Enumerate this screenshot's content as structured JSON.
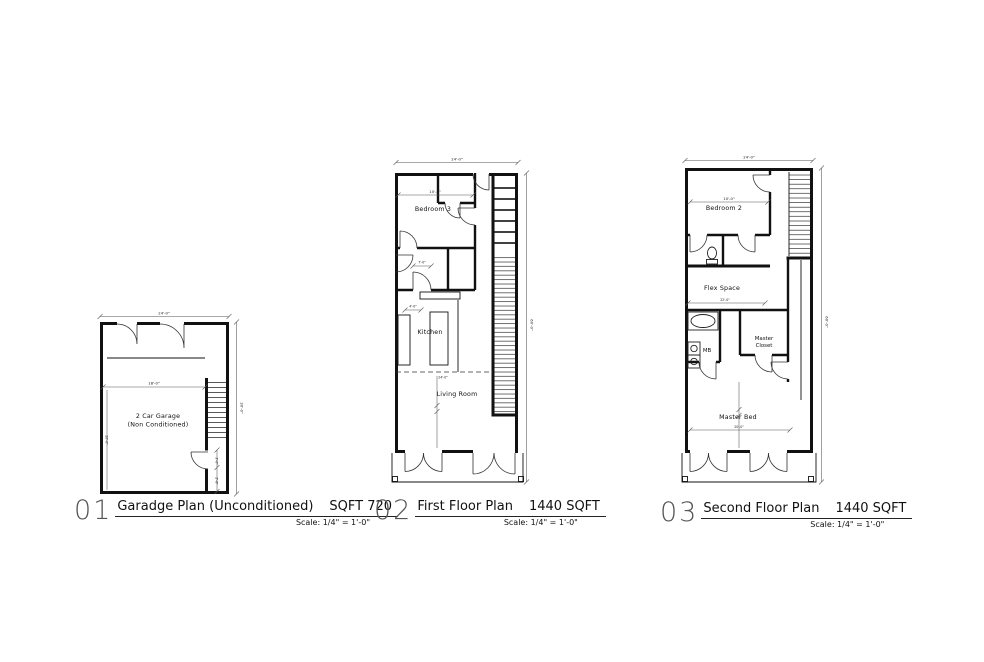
{
  "sheet": {
    "background": "#ffffff",
    "ink": "#111111",
    "dim_ink": "#555555",
    "plans": [
      {
        "number": "01",
        "title": "Garadge Plan (Unconditioned)",
        "sqft": "SQFT 720",
        "scale": "Scale: 1/4\" = 1'-0\"",
        "labels": {
          "room_line1": "2 Car Garage",
          "room_line2": "(Non Conditioned)"
        },
        "dims": {
          "top": "24'-0\"",
          "right": "30'-0\"",
          "interior_width": "18'-0\"",
          "interior_height": "20'-0\"",
          "stair_door": "3'-0\"",
          "stair_landing": "2'-8\""
        }
      },
      {
        "number": "02",
        "title": "First Floor Plan",
        "sqft": "1440 SQFT",
        "scale": "Scale: 1/4\" = 1'-0\"",
        "labels": {
          "bedroom": "Bedroom 3",
          "kitchen": "Kitchen",
          "living": "Living Room"
        },
        "dims": {
          "top": "24'-0\"",
          "right": "60'-0\"",
          "bedroom_width": "10'-0\"",
          "bath_width": "7'-0\"",
          "kitchen_island": "4'-0\"",
          "living_width": "24'-0\""
        }
      },
      {
        "number": "03",
        "title": "Second Floor Plan",
        "sqft": "1440 SQFT",
        "scale": "Scale: 1/4\" = 1'-0\"",
        "labels": {
          "bedroom": "Bedroom 2",
          "flex": "Flex Space",
          "mb": "MB",
          "closet_line1": "Master",
          "closet_line2": "Closet",
          "master": "Master Bed"
        },
        "dims": {
          "top": "24'-0\"",
          "right": "60'-0\"",
          "bedroom_width": "10'-0\"",
          "flex_width": "22'-0\"",
          "master_width": "20'-0\""
        }
      }
    ]
  }
}
